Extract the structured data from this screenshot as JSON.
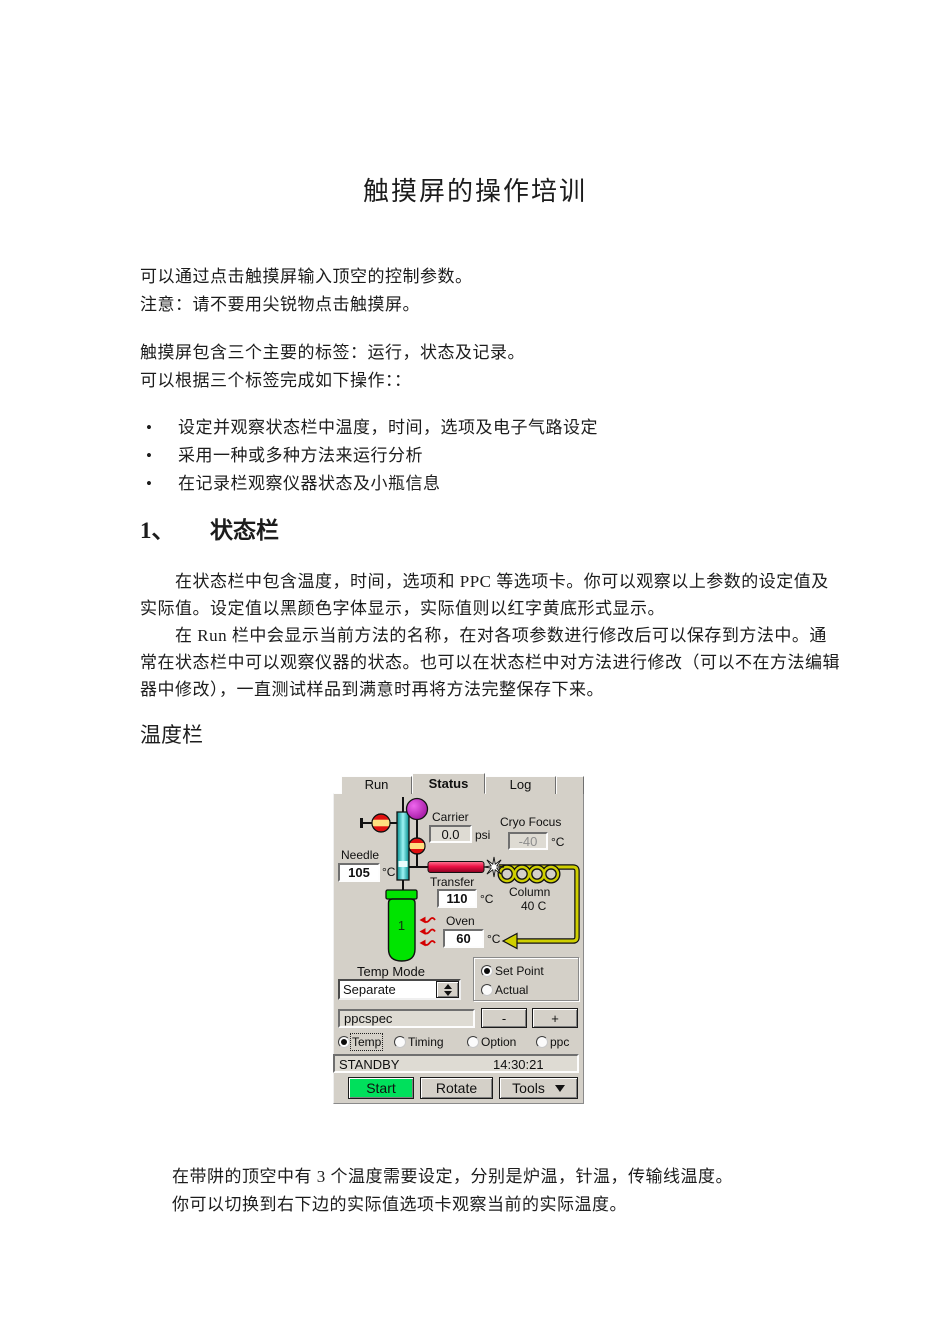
{
  "icons": {
    "bullet": "•"
  },
  "page": {
    "title": "触摸屏的操作培训",
    "intro_lines": [
      "可以通过点击触摸屏输入顶空的控制参数。",
      "注意：请不要用尖锐物点击触摸屏。"
    ],
    "tab_lines": [
      "触摸屏包含三个主要的标签：运行，状态及记录。",
      "可以根据三个标签完成如下操作：："
    ],
    "bullets": [
      "设定并观察状态栏中温度，时间，选项及电子气路设定",
      "采用一种或多种方法来运行分析",
      "在记录栏观察仪器状态及小瓶信息"
    ],
    "section1": {
      "number": "1、",
      "title": "状态栏",
      "lines": [
        "在状态栏中包含温度，时间，选项和 PPC 等选项卡。你可以观察以上参数的设定值及",
        "实际值。设定值以黑颜色字体显示，实际值则以红字黄底形式显示。",
        "在 Run 栏中会显示当前方法的名称，在对各项参数进行修改后可以保存到方法中。通",
        "常在状态栏中可以观察仪器的状态。也可以在状态栏中对方法进行修改（可以不在方法编辑",
        "器中修改），一直测试样品到满意时再将方法完整保存下来。"
      ]
    },
    "subheading": "温度栏",
    "footer_lines": [
      "在带阱的顶空中有 3 个温度需要设定，分别是炉温，针温，传输线温度。",
      "你可以切换到右下边的实际值选项卡观察当前的实际温度。"
    ]
  },
  "panel": {
    "tabs": [
      {
        "label": "Run",
        "active": false
      },
      {
        "label": "Status",
        "active": true
      },
      {
        "label": "Log",
        "active": false
      }
    ],
    "carrier": {
      "label": "Carrier",
      "value": "0.0",
      "unit": "psi"
    },
    "cryo_focus": {
      "label": "Cryo Focus",
      "value": "-40",
      "unit": "°C"
    },
    "needle": {
      "label": "Needle",
      "value": "105",
      "unit": "°C"
    },
    "transfer": {
      "label": "Transfer",
      "value": "110",
      "unit": "°C"
    },
    "column": {
      "label": "Column",
      "value": "40 C"
    },
    "oven": {
      "label": "Oven",
      "value": "60",
      "unit": "°C"
    },
    "vial": {
      "number": "1"
    },
    "temp_mode": {
      "label": "Temp Mode",
      "selected": "Separate"
    },
    "display_mode": {
      "options": [
        {
          "label": "Set Point",
          "selected": true
        },
        {
          "label": "Actual",
          "selected": false
        }
      ]
    },
    "ppc_field": {
      "value": "ppcspec"
    },
    "minus_button": "-",
    "plus_button": "+",
    "category_radios": [
      {
        "label": "Temp",
        "selected": true
      },
      {
        "label": "Timing",
        "selected": false
      },
      {
        "label": "Option",
        "selected": false
      },
      {
        "label": "ppc",
        "selected": false
      }
    ],
    "status_bar": {
      "state": "STANDBY",
      "time": "14:30:21"
    },
    "action_buttons": [
      {
        "label": "Start"
      },
      {
        "label": "Rotate"
      },
      {
        "label": "Tools"
      }
    ]
  },
  "colors": {
    "panel_bg": "#d4d0c8",
    "field_gray": "#dedbd3",
    "disabled_text": "#8d8d8d",
    "transfer_red": "#ee1144",
    "needle_cyan": "#4fe3e3",
    "vial_green": "#00e400",
    "start_green": "#00e05c",
    "valve_red": "#e01010",
    "valve_stripe": "#ffdf80",
    "purple": "#bb14bb",
    "flow_yellow": "#cfcf00",
    "heat_red": "#d40000"
  }
}
